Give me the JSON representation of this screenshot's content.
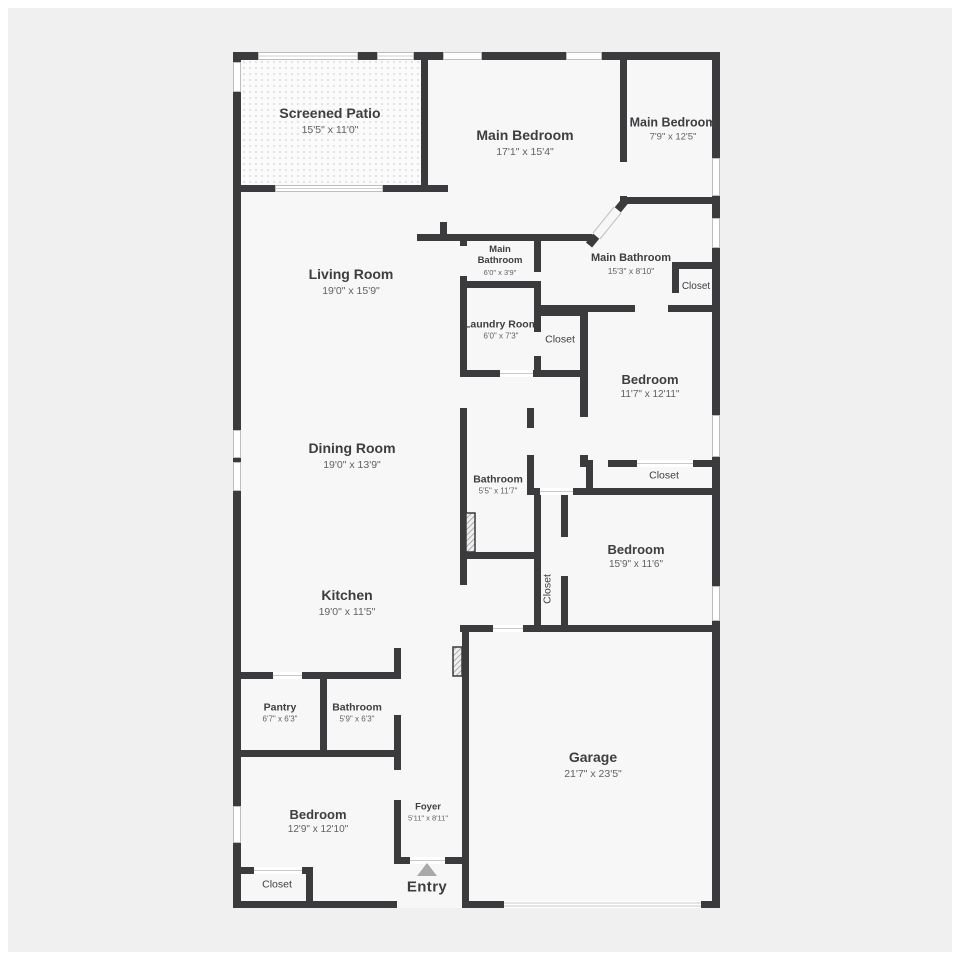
{
  "palette": {
    "background": "#f0f0f0",
    "frame": "#ffffff",
    "wall": "#3b3b3d",
    "room_fill": "#f7f7f7",
    "window": "#ffffff",
    "text_primary": "#3e3e40",
    "text_dims": "#616161",
    "entry_arrow": "#a9a9a9"
  },
  "rooms": {
    "screened_patio": {
      "name": "Screened Patio",
      "dims": "15'5\" x 11'0\""
    },
    "main_bedroom": {
      "name": "Main Bedroom",
      "dims": "17'1\" x 15'4\""
    },
    "main_bedroom_2": {
      "name": "Main Bedroom",
      "dims": "7'9\" x 12'5\""
    },
    "main_bathroom_small": {
      "name": "Main Bathroom",
      "dims": "6'0\" x 3'9\""
    },
    "main_bathroom": {
      "name": "Main Bathroom",
      "dims": "15'3\" x 8'10\""
    },
    "laundry_room": {
      "name": "Laundry Room",
      "dims": "6'0\" x 7'3\""
    },
    "bedroom_ne": {
      "name": "Bedroom",
      "dims": "11'7\" x 12'11\""
    },
    "bathroom_mid": {
      "name": "Bathroom",
      "dims": "5'5\" x 11'7\""
    },
    "bedroom_e": {
      "name": "Bedroom",
      "dims": "15'9\" x 11'6\""
    },
    "living_room": {
      "name": "Living Room",
      "dims": "19'0\" x 15'9\""
    },
    "dining_room": {
      "name": "Dining Room",
      "dims": "19'0\" x 13'9\""
    },
    "kitchen": {
      "name": "Kitchen",
      "dims": "19'0\" x 11'5\""
    },
    "pantry": {
      "name": "Pantry",
      "dims": "6'7\" x 6'3\""
    },
    "bathroom_sw": {
      "name": "Bathroom",
      "dims": "5'9\" x 6'3\""
    },
    "bedroom_sw": {
      "name": "Bedroom",
      "dims": "12'9\" x 12'10\""
    },
    "foyer": {
      "name": "Foyer",
      "dims": "5'11\" x 8'11\""
    },
    "garage": {
      "name": "Garage",
      "dims": "21'7\" x 23'5\""
    }
  },
  "closets": {
    "main_bath": "Closet",
    "laundry": "Closet",
    "bedroom_ne": "Closet",
    "bedroom_e": "Closet",
    "bedroom_sw": "Closet"
  },
  "entry": {
    "label": "Entry"
  }
}
